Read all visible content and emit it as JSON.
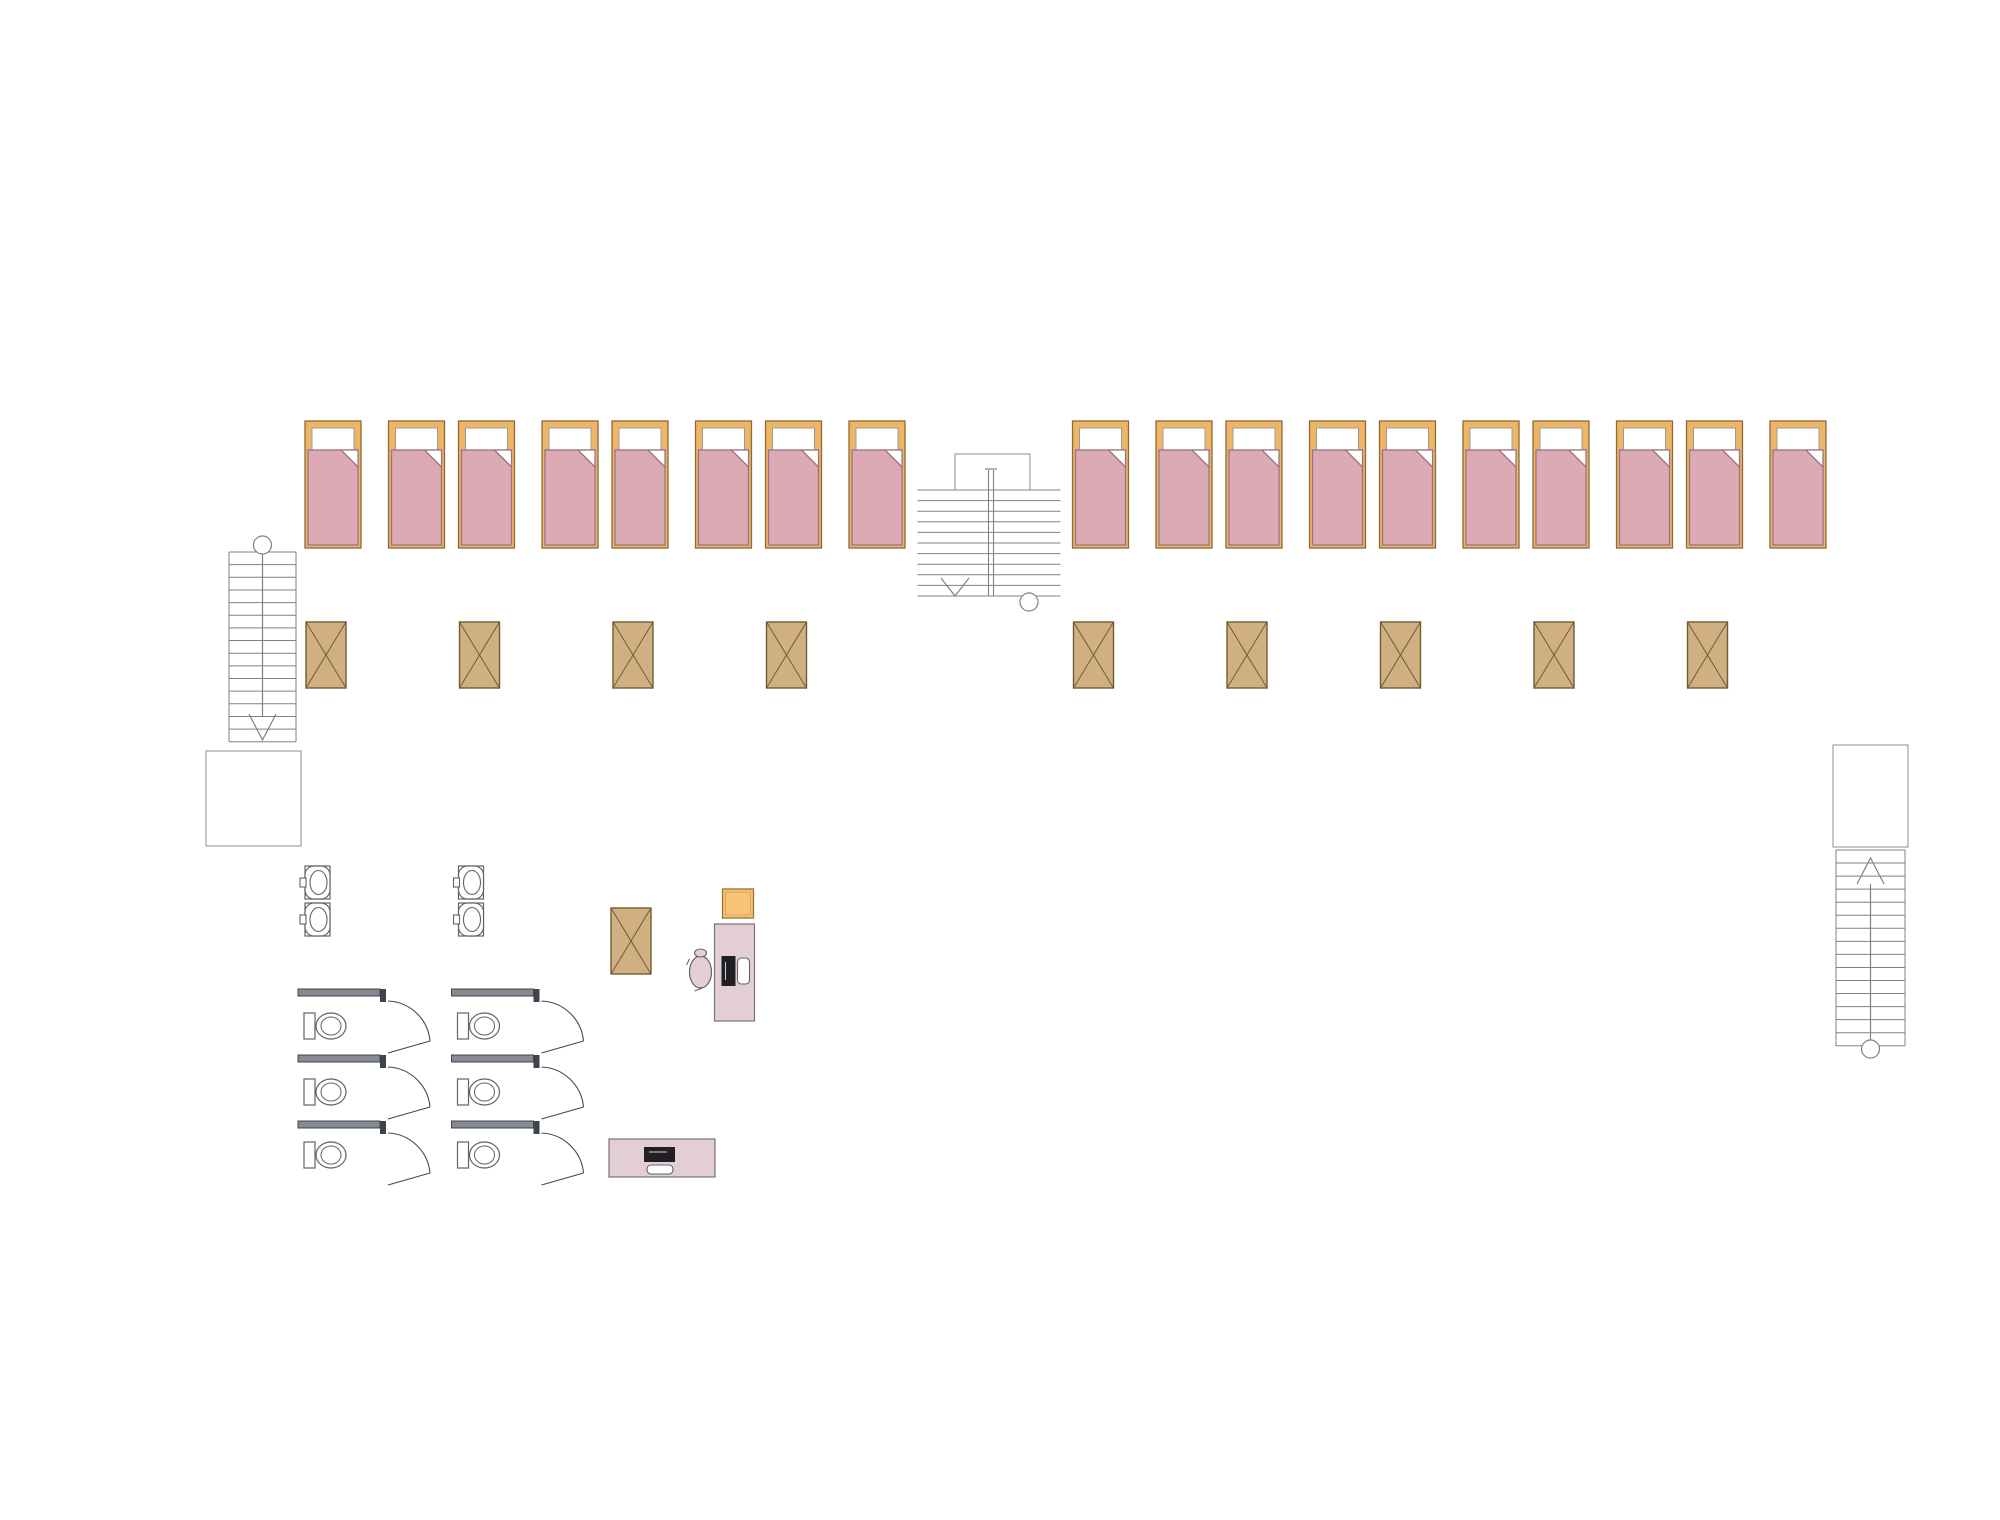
{
  "plan": {
    "title": "modular-building-floor-plan",
    "dimension_labels": {
      "top_total": "24 000",
      "top_modules": [
        "2 400",
        "2 400",
        "2 400",
        "2 400",
        "2 400",
        "2 400",
        "2 400",
        "2 400",
        "2 400",
        "2 400"
      ],
      "left_total": "12 000",
      "left_segments": [
        "5 250",
        "1 500",
        "5 250"
      ]
    },
    "watermark": {
      "full_text": "VANDA",
      "text_left": "VAN",
      "text_right": "DA"
    },
    "modules": [
      {
        "id": 1,
        "north": "bedroom",
        "south": "sanitary"
      },
      {
        "id": 2,
        "north": "bedroom",
        "south": "sanitary"
      },
      {
        "id": 3,
        "north": "bedroom",
        "south": "workroom"
      },
      {
        "id": 4,
        "north": "bedroom",
        "south": "workroom"
      },
      {
        "id": 5,
        "north": "staircase",
        "south": "workroom"
      },
      {
        "id": 6,
        "north": "bedroom",
        "south": "workroom"
      },
      {
        "id": 7,
        "north": "bedroom",
        "south": "workroom"
      },
      {
        "id": 8,
        "north": "bedroom",
        "south": "workroom"
      },
      {
        "id": 9,
        "north": "bedroom",
        "south": "workroom"
      },
      {
        "id": 10,
        "north": "bedroom",
        "south": "workroom"
      }
    ],
    "symbols": [
      "bed",
      "wardrobe",
      "desk",
      "office-chair",
      "stool",
      "monitor",
      "keyboard",
      "washbasin",
      "toilet",
      "staircase",
      "door",
      "window"
    ],
    "colors": {
      "wall": "#858b90",
      "wall_edge": "#41464b",
      "jamb": "#3f444a",
      "line": "#44484c",
      "stair_line": "#7d8286",
      "dim": "#111111",
      "bed_frame": "#eeb566",
      "bed_frame_edge": "#8a6b3a",
      "blanket": "#dcaab4",
      "blanket_edge": "#9b7280",
      "wardrobe": "#d0b082",
      "wardrobe_edge": "#715c32",
      "desk": "#e4ced6",
      "desk_edge": "#77717a",
      "chair_yellow": "#f6c377",
      "chair_yellow_edge": "#97742f",
      "screen": "#202024",
      "fixture_edge": "#5f6468",
      "logo_pink": "#f2aab6",
      "logo_pink_top": "#f7c6cd",
      "logo_blue": "#c3dcee",
      "logo_blue_top": "#d7e9f6",
      "logo_text": "#ffffff"
    }
  }
}
